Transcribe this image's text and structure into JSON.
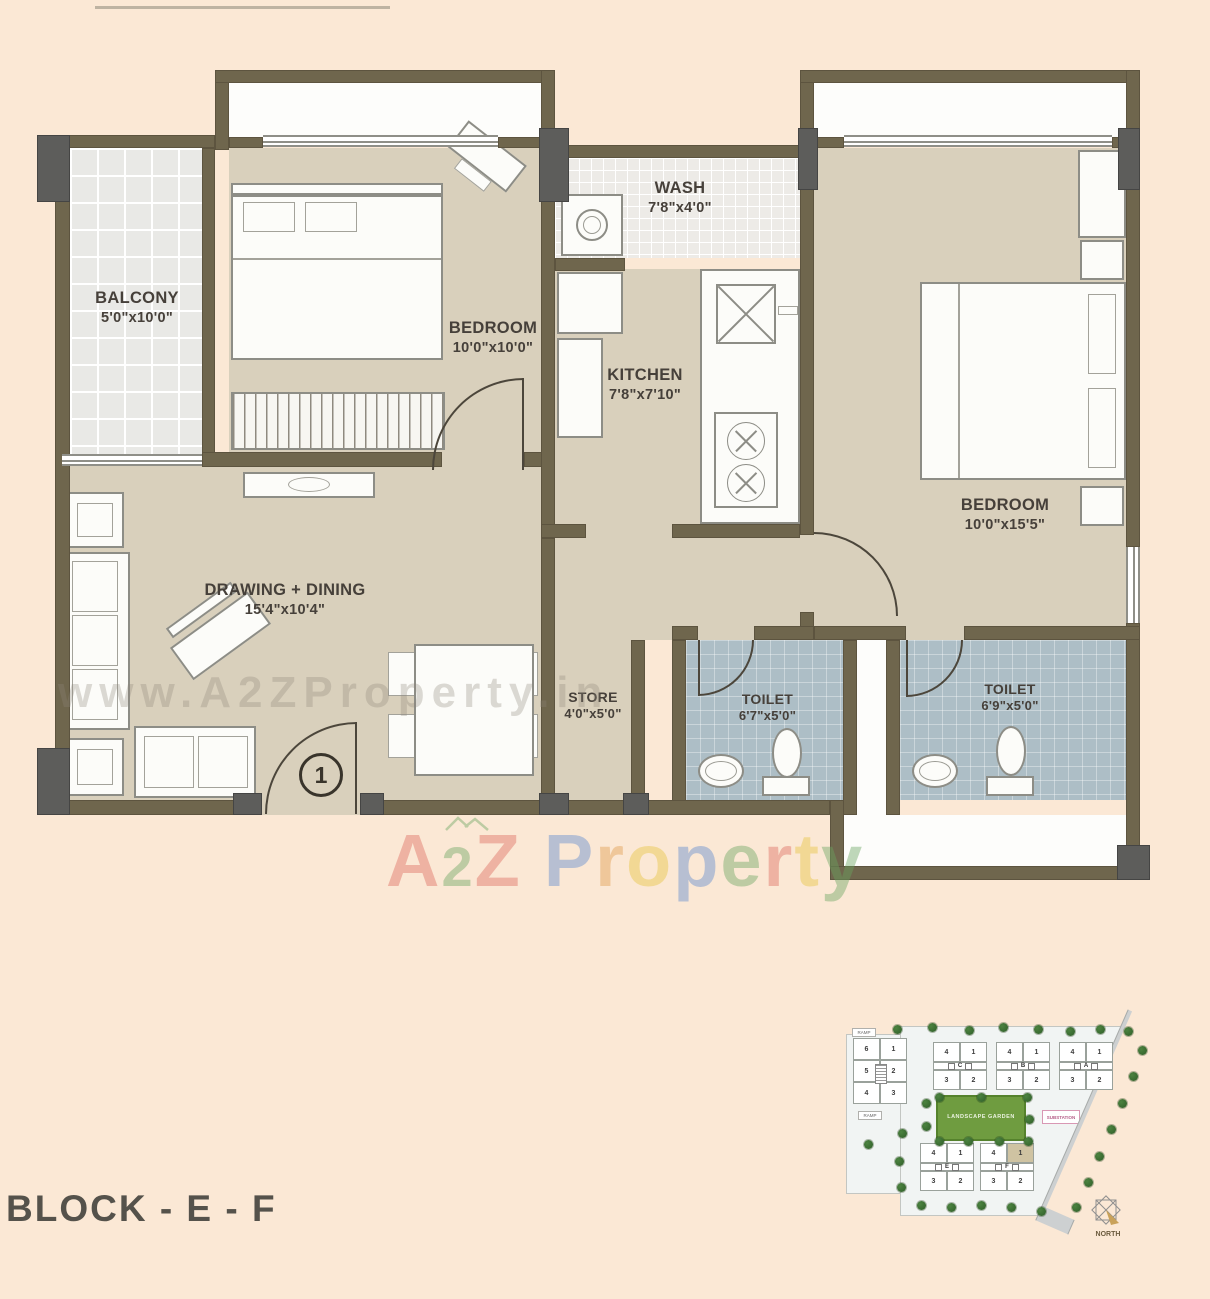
{
  "page": {
    "background": "#fbe8d5",
    "block_label": "BLOCK - E - F"
  },
  "watermark": {
    "url_text": "www.A2ZProperty.in",
    "brand_letters": [
      {
        "ch": "A",
        "color": "#dd6a5e"
      },
      {
        "ch": "2",
        "color": "#6aa55f",
        "small": true
      },
      {
        "ch": "Z",
        "color": "#dd6a5e"
      },
      {
        "ch": "P",
        "color": "#5b87cf",
        "gap": true
      },
      {
        "ch": "r",
        "color": "#e09a4a"
      },
      {
        "ch": "o",
        "color": "#e7c43d"
      },
      {
        "ch": "p",
        "color": "#5b87cf"
      },
      {
        "ch": "e",
        "color": "#6aa55f"
      },
      {
        "ch": "r",
        "color": "#dd6a5e"
      },
      {
        "ch": "t",
        "color": "#e7c43d"
      },
      {
        "ch": "y",
        "color": "#6aa55f"
      }
    ]
  },
  "rooms": {
    "balcony": {
      "name": "BALCONY",
      "dims": "5'0\"x10'0\""
    },
    "bedroom1": {
      "name": "BEDROOM",
      "dims": "10'0\"x10'0\""
    },
    "wash": {
      "name": "WASH",
      "dims": "7'8\"x4'0\""
    },
    "kitchen": {
      "name": "KITCHEN",
      "dims": "7'8\"x7'10\""
    },
    "bedroom2": {
      "name": "BEDROOM",
      "dims": "10'0\"x15'5\""
    },
    "drawing_dining": {
      "name": "DRAWING + DINING",
      "dims": "15'4\"x10'4\""
    },
    "store": {
      "name": "STORE",
      "dims": "4'0\"x5'0\""
    },
    "toilet1": {
      "name": "TOILET",
      "dims": "6'7\"x5'0\""
    },
    "toilet2": {
      "name": "TOILET",
      "dims": "6'9\"x5'0\""
    }
  },
  "entrance": {
    "marker": "1"
  },
  "site_plan": {
    "garden_label": "LANDSCAPE GARDEN",
    "substation_label": "SUBSTATION",
    "north_label": "NORTH",
    "ramp_label": "RAMP",
    "road_label": "ROAD",
    "block_d_rows": [
      [
        "6",
        "1"
      ],
      [
        "5",
        "2"
      ],
      [
        "4",
        "3"
      ]
    ],
    "lettered_blocks": [
      {
        "letter": "C",
        "top": [
          "4",
          "1"
        ],
        "bottom": [
          "3",
          "2"
        ]
      },
      {
        "letter": "B",
        "top": [
          "4",
          "1"
        ],
        "bottom": [
          "3",
          "2"
        ]
      },
      {
        "letter": "A",
        "top": [
          "4",
          "1"
        ],
        "bottom": [
          "3",
          "2"
        ]
      },
      {
        "letter": "E",
        "top": [
          "4",
          "1"
        ],
        "bottom": [
          "3",
          "2"
        ]
      },
      {
        "letter": "F",
        "top": [
          "4",
          "1"
        ],
        "bottom": [
          "3",
          "2"
        ],
        "highlight": "1"
      }
    ]
  }
}
